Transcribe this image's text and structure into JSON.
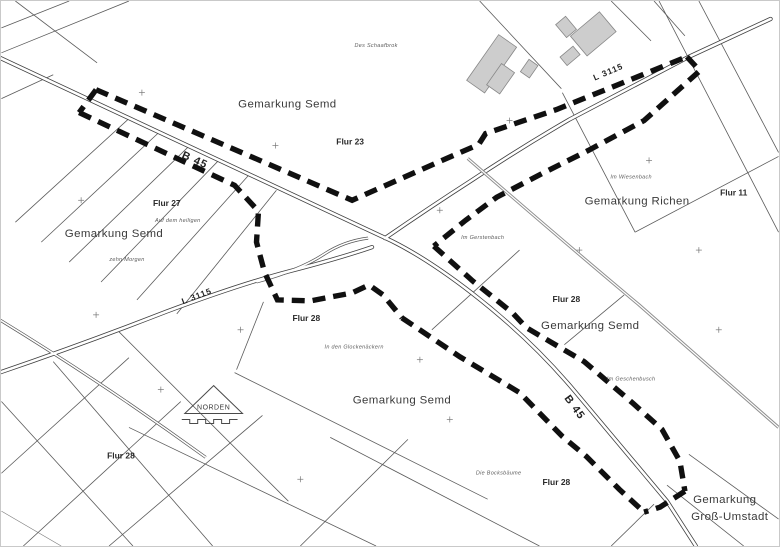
{
  "map": {
    "regions": [
      {
        "text": "Gemarkung Semd"
      },
      {
        "text": "Gemarkung Semd"
      },
      {
        "text": "Gemarkung Richen"
      },
      {
        "text": "Gemarkung Semd"
      },
      {
        "text": "Gemarkung Semd"
      },
      {
        "text": "Gemarkung"
      },
      {
        "text": "Groß-Umstadt"
      }
    ],
    "flur_labels": [
      {
        "text": "Flur 23"
      },
      {
        "text": "Flur 27"
      },
      {
        "text": "Flur 11"
      },
      {
        "text": "Flur 28"
      },
      {
        "text": "Flur 28"
      },
      {
        "text": "Flur 28"
      },
      {
        "text": "Flur 28"
      }
    ],
    "roads": [
      {
        "label": "B 45"
      },
      {
        "label": "B 45"
      },
      {
        "label": "L 3115"
      },
      {
        "label": "L 3115"
      }
    ],
    "field_names": [
      {
        "text": "Des Schaafbrok"
      },
      {
        "text": "Im Wiesenbach"
      },
      {
        "text": "Im Gerstenbach"
      },
      {
        "text": "Auf dem heiligen"
      },
      {
        "text": "zehn Morgen"
      },
      {
        "text": "In den Glockenäckern"
      },
      {
        "text": "Im Geschenbusch"
      },
      {
        "text": "Die Bocksbäume"
      }
    ],
    "north_arrow": {
      "label": "NORDEN"
    },
    "colors": {
      "background": "#ffffff",
      "boundary": "#101010",
      "parcel_line": "#5a5a5a",
      "building_fill": "#cdcdcd",
      "gray_track": "#8f8f8f"
    }
  }
}
